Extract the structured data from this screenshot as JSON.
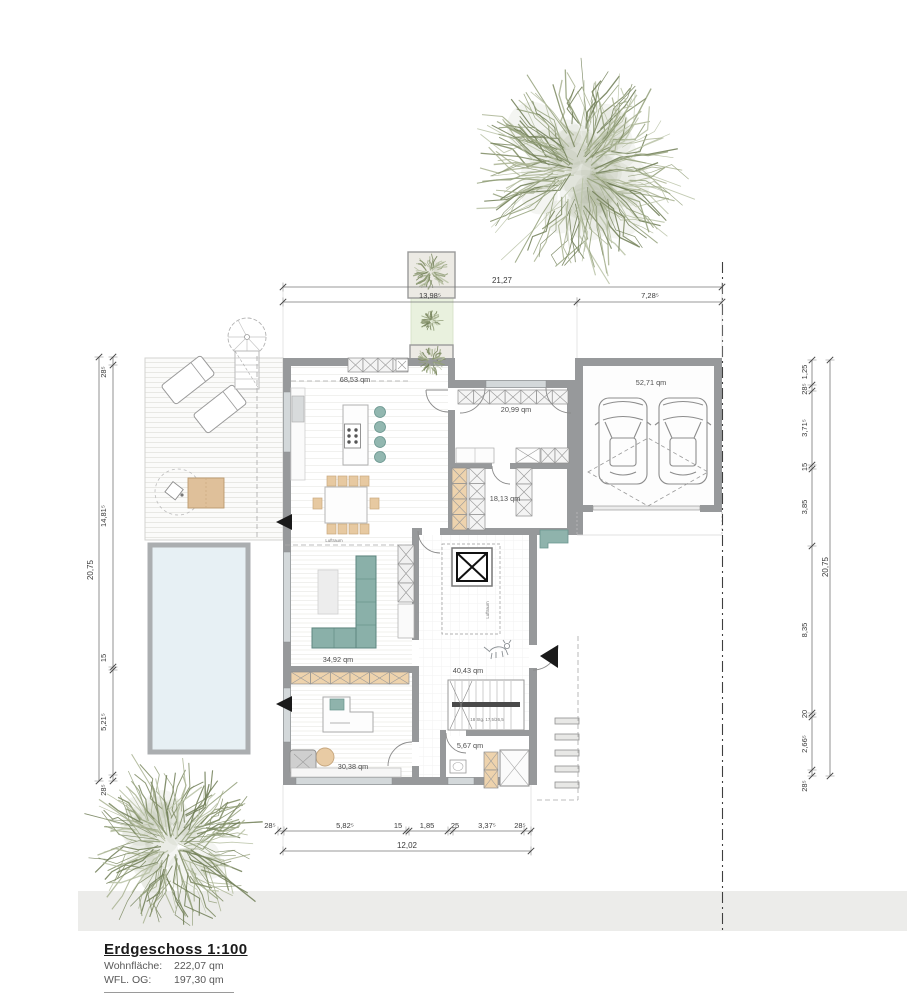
{
  "title_block": {
    "title": "Erdgeschoss 1:100",
    "area_label": "Wohnfläche:",
    "area_value": "222,07 qm",
    "upper_label": "WFL. OG:",
    "upper_value": "197,30 qm"
  },
  "dimensions": {
    "top": {
      "total": "21,27",
      "left": "13,98⁵",
      "right": "7,28⁵"
    },
    "bottom": {
      "total": "12,02",
      "segments": [
        "28⁵",
        "5,82⁵",
        "15",
        "1,85",
        "25",
        "3,37⁵",
        "28⁵"
      ]
    },
    "left": {
      "total": "20,75",
      "segments": [
        "28⁵",
        "14,81⁵",
        "15",
        "5,21⁵",
        "28⁵"
      ]
    },
    "right": {
      "total": "20,75",
      "segments": [
        "1,25",
        "28⁵",
        "3,71⁵",
        "15",
        "3,85",
        "8,35",
        "20",
        "2,66⁵",
        "28⁵"
      ]
    }
  },
  "rooms": {
    "kitchen_dining": {
      "label": "68,53 qm"
    },
    "entry": {
      "label": "20,99 qm"
    },
    "hallway": {
      "label": "18,13 qm"
    },
    "garage": {
      "label": "52,71 qm"
    },
    "living": {
      "label": "34,92 qm"
    },
    "hall": {
      "label": "40,43 qm"
    },
    "office": {
      "label": "30,38 qm"
    },
    "bath": {
      "label": "5,67 qm"
    }
  },
  "annotations": {
    "air_space_living": "Luftraum",
    "air_space_hall": "Luftraum",
    "stair_note": "18 Stg. 17,5/26,5"
  },
  "colors": {
    "wall": "#97999b",
    "window": "#d3d8da",
    "pool": "#e7f0f4",
    "path_green": "#e9f1de",
    "furniture_teal": "#8fb3ac",
    "furniture_tan": "#eed3ad",
    "tree_olive": "#8e9a76",
    "street": "#ececea"
  }
}
